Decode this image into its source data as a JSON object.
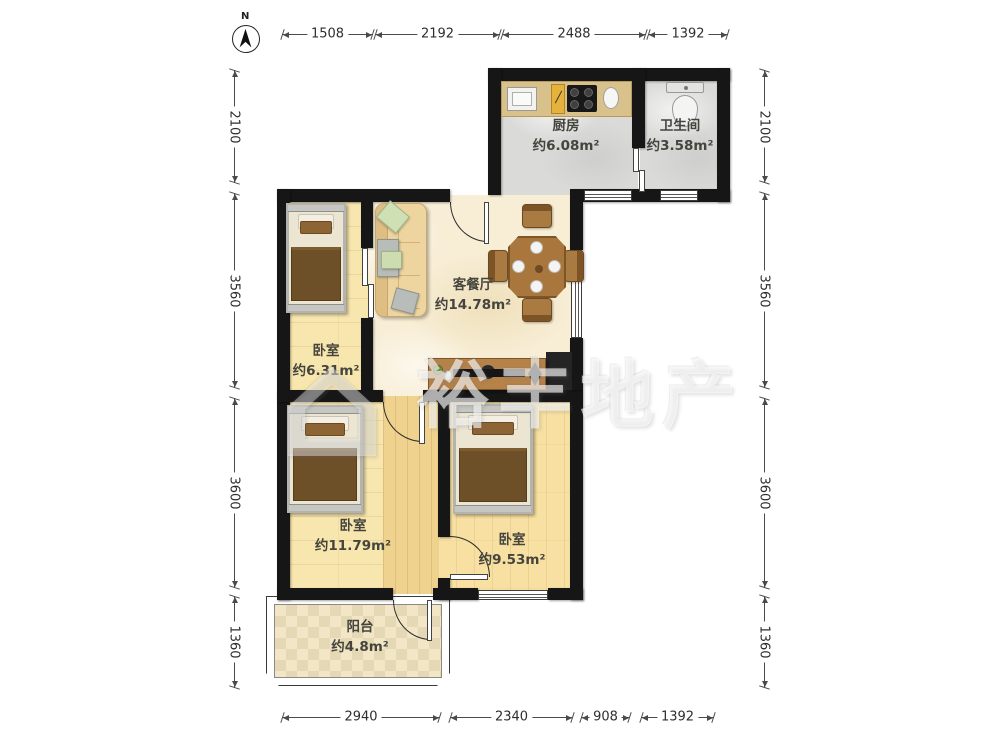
{
  "plan": {
    "compass_label": "N",
    "watermark": "裕丰地产",
    "watermark_logo": "⌂",
    "rooms": [
      {
        "id": "kitchen",
        "name": "厨房",
        "area": "约6.08m²"
      },
      {
        "id": "bathroom",
        "name": "卫生间",
        "area": "约3.58m²"
      },
      {
        "id": "living-dining",
        "name": "客餐厅",
        "area": "约14.78m²"
      },
      {
        "id": "bedroom-small",
        "name": "卧室",
        "area": "约6.31m²"
      },
      {
        "id": "bedroom-large",
        "name": "卧室",
        "area": "约11.79m²"
      },
      {
        "id": "bedroom-mid",
        "name": "卧室",
        "area": "约9.53m²"
      },
      {
        "id": "balcony",
        "name": "阳台",
        "area": "约4.8m²"
      }
    ],
    "dimensions_mm": {
      "top": [
        "1508",
        "2192",
        "2488",
        "1392"
      ],
      "bottom": [
        "2940",
        "2340",
        "908",
        "1392"
      ],
      "left": [
        "2100",
        "3560",
        "3600",
        "1360"
      ],
      "right": [
        "2100",
        "3560",
        "3600",
        "1360"
      ]
    },
    "colors": {
      "wall": "#161616",
      "wood_floor": "#f8e6af",
      "marble_floor": "#f8eed6",
      "tile_gray": "#dadad8",
      "counter_tan": "#d8c18b",
      "furniture_brown": "#a9763d"
    }
  }
}
